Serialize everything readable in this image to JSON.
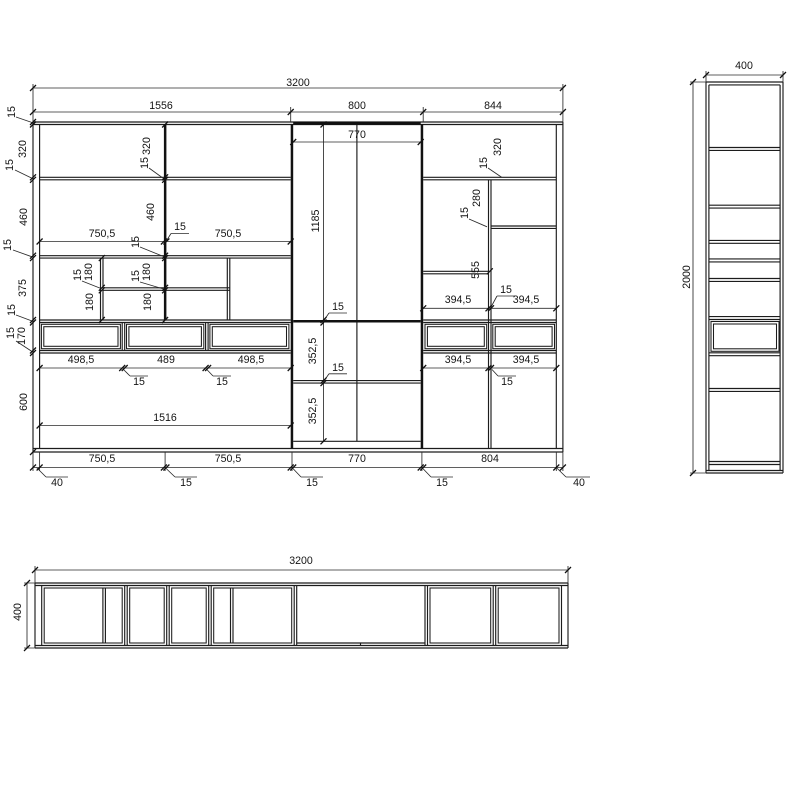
{
  "drawing": {
    "kind": "furniture technical drawing",
    "views": {
      "front_elevation": {
        "overall_width_mm": "3200",
        "overall_height_mm": "2000",
        "section_widths_mm": [
          "1556",
          "800",
          "844"
        ],
        "left_height_chain_mm": [
          "15",
          "320",
          "15",
          "460",
          "15",
          "375",
          "15",
          "170",
          "15",
          "600"
        ],
        "bottom_chain_mm": [
          "40",
          "750,5",
          "15",
          "750,5",
          "15",
          "770",
          "15",
          "804",
          "40"
        ],
        "drawer_widths_mm": [
          "498,5",
          "489",
          "498,5",
          "394,5",
          "394,5"
        ]
      },
      "side_elevation": {
        "width_mm": "400",
        "height_mm": "2000"
      },
      "plan_view": {
        "width_mm": "3200",
        "depth_mm": "400"
      }
    },
    "colors": {
      "line": "#1c1c1c",
      "background": "#ffffff"
    }
  },
  "labels": [
    {
      "t": "3200",
      "x": 298,
      "y": 83,
      "r": 0,
      "g": "front-top"
    },
    {
      "t": "1556",
      "x": 161,
      "y": 106,
      "r": 0,
      "g": "front-top"
    },
    {
      "t": "800",
      "x": 357,
      "y": 106,
      "r": 0,
      "g": "front-top"
    },
    {
      "t": "844",
      "x": 493,
      "y": 106,
      "r": 0,
      "g": "front-top"
    },
    {
      "t": "770",
      "x": 357,
      "y": 135,
      "r": 0,
      "g": "front-top"
    },
    {
      "t": "15",
      "x": 12,
      "y": 112,
      "r": 1,
      "g": "front-left"
    },
    {
      "t": "320",
      "x": 23,
      "y": 149,
      "r": 1,
      "g": "front-left"
    },
    {
      "t": "15",
      "x": 10,
      "y": 165,
      "r": 1,
      "g": "front-left"
    },
    {
      "t": "460",
      "x": 24,
      "y": 217,
      "r": 1,
      "g": "front-left"
    },
    {
      "t": "15",
      "x": 8,
      "y": 245,
      "r": 1,
      "g": "front-left"
    },
    {
      "t": "375",
      "x": 23,
      "y": 288,
      "r": 1,
      "g": "front-left"
    },
    {
      "t": "15",
      "x": 12,
      "y": 310,
      "r": 1,
      "g": "front-left"
    },
    {
      "t": "15",
      "x": 11,
      "y": 333,
      "r": 1,
      "g": "front-left"
    },
    {
      "t": "170",
      "x": 22,
      "y": 336,
      "r": 1,
      "g": "front-left"
    },
    {
      "t": "600",
      "x": 24,
      "y": 402,
      "r": 1,
      "g": "front-left"
    },
    {
      "t": "320",
      "x": 147,
      "y": 146,
      "r": 1,
      "g": "front-divider"
    },
    {
      "t": "15",
      "x": 145,
      "y": 163,
      "r": 1,
      "g": "front-divider"
    },
    {
      "t": "460",
      "x": 151,
      "y": 212,
      "r": 1,
      "g": "front-divider"
    },
    {
      "t": "15",
      "x": 136,
      "y": 242,
      "r": 1,
      "g": "front-divider"
    },
    {
      "t": "750,5",
      "x": 102,
      "y": 234,
      "r": 0,
      "g": "front-row2"
    },
    {
      "t": "15",
      "x": 180,
      "y": 227,
      "r": 0,
      "g": "front-row2"
    },
    {
      "t": "750,5",
      "x": 228,
      "y": 234,
      "r": 0,
      "g": "front-row2"
    },
    {
      "t": "15",
      "x": 78,
      "y": 275,
      "r": 1,
      "g": "front-row3"
    },
    {
      "t": "180",
      "x": 89,
      "y": 272,
      "r": 1,
      "g": "front-row3"
    },
    {
      "t": "180",
      "x": 90,
      "y": 302,
      "r": 1,
      "g": "front-row3"
    },
    {
      "t": "15",
      "x": 136,
      "y": 276,
      "r": 1,
      "g": "front-row3"
    },
    {
      "t": "180",
      "x": 147,
      "y": 272,
      "r": 1,
      "g": "front-row3"
    },
    {
      "t": "180",
      "x": 148,
      "y": 302,
      "r": 1,
      "g": "front-row3"
    },
    {
      "t": "1185",
      "x": 316,
      "y": 221,
      "r": 1,
      "g": "front-middle"
    },
    {
      "t": "15",
      "x": 338,
      "y": 307,
      "r": 0,
      "g": "front-middle"
    },
    {
      "t": "352,5",
      "x": 313,
      "y": 351,
      "r": 1,
      "g": "front-middle"
    },
    {
      "t": "15",
      "x": 338,
      "y": 368,
      "r": 0,
      "g": "front-middle"
    },
    {
      "t": "352,5",
      "x": 313,
      "y": 411,
      "r": 1,
      "g": "front-middle"
    },
    {
      "t": "15",
      "x": 484,
      "y": 163,
      "r": 1,
      "g": "front-right"
    },
    {
      "t": "320",
      "x": 498,
      "y": 147,
      "r": 1,
      "g": "front-right"
    },
    {
      "t": "15",
      "x": 465,
      "y": 213,
      "r": 1,
      "g": "front-right"
    },
    {
      "t": "280",
      "x": 477,
      "y": 198,
      "r": 1,
      "g": "front-right"
    },
    {
      "t": "555",
      "x": 476,
      "y": 270,
      "r": 1,
      "g": "front-right"
    },
    {
      "t": "394,5",
      "x": 458,
      "y": 300,
      "r": 0,
      "g": "front-right"
    },
    {
      "t": "15",
      "x": 506,
      "y": 290,
      "r": 0,
      "g": "front-right"
    },
    {
      "t": "394,5",
      "x": 526,
      "y": 300,
      "r": 0,
      "g": "front-right"
    },
    {
      "t": "394,5",
      "x": 458,
      "y": 360,
      "r": 0,
      "g": "front-right"
    },
    {
      "t": "394,5",
      "x": 526,
      "y": 360,
      "r": 0,
      "g": "front-right"
    },
    {
      "t": "15",
      "x": 507,
      "y": 382,
      "r": 0,
      "g": "front-right"
    },
    {
      "t": "498,5",
      "x": 81,
      "y": 360,
      "r": 0,
      "g": "front-drawers"
    },
    {
      "t": "489",
      "x": 166,
      "y": 360,
      "r": 0,
      "g": "front-drawers"
    },
    {
      "t": "498,5",
      "x": 251,
      "y": 360,
      "r": 0,
      "g": "front-drawers"
    },
    {
      "t": "15",
      "x": 139,
      "y": 382,
      "r": 0,
      "g": "front-drawers"
    },
    {
      "t": "15",
      "x": 222,
      "y": 382,
      "r": 0,
      "g": "front-drawers"
    },
    {
      "t": "1516",
      "x": 165,
      "y": 418,
      "r": 0,
      "g": "front-bottom-row"
    },
    {
      "t": "750,5",
      "x": 102,
      "y": 459,
      "r": 0,
      "g": "front-bottom-chain"
    },
    {
      "t": "750,5",
      "x": 228,
      "y": 459,
      "r": 0,
      "g": "front-bottom-chain"
    },
    {
      "t": "770",
      "x": 357,
      "y": 459,
      "r": 0,
      "g": "front-bottom-chain"
    },
    {
      "t": "804",
      "x": 490,
      "y": 459,
      "r": 0,
      "g": "front-bottom-chain"
    },
    {
      "t": "40",
      "x": 57,
      "y": 483,
      "r": 0,
      "g": "front-bottom-chain"
    },
    {
      "t": "15",
      "x": 186,
      "y": 483,
      "r": 0,
      "g": "front-bottom-chain"
    },
    {
      "t": "15",
      "x": 312,
      "y": 483,
      "r": 0,
      "g": "front-bottom-chain"
    },
    {
      "t": "15",
      "x": 442,
      "y": 483,
      "r": 0,
      "g": "front-bottom-chain"
    },
    {
      "t": "40",
      "x": 579,
      "y": 483,
      "r": 0,
      "g": "front-bottom-chain"
    },
    {
      "t": "400",
      "x": 744,
      "y": 66,
      "r": 0,
      "g": "side"
    },
    {
      "t": "2000",
      "x": 687,
      "y": 277,
      "r": 1,
      "g": "side"
    },
    {
      "t": "3200",
      "x": 301,
      "y": 561,
      "r": 0,
      "g": "plan"
    },
    {
      "t": "400",
      "x": 18,
      "y": 612,
      "r": 1,
      "g": "plan"
    }
  ]
}
